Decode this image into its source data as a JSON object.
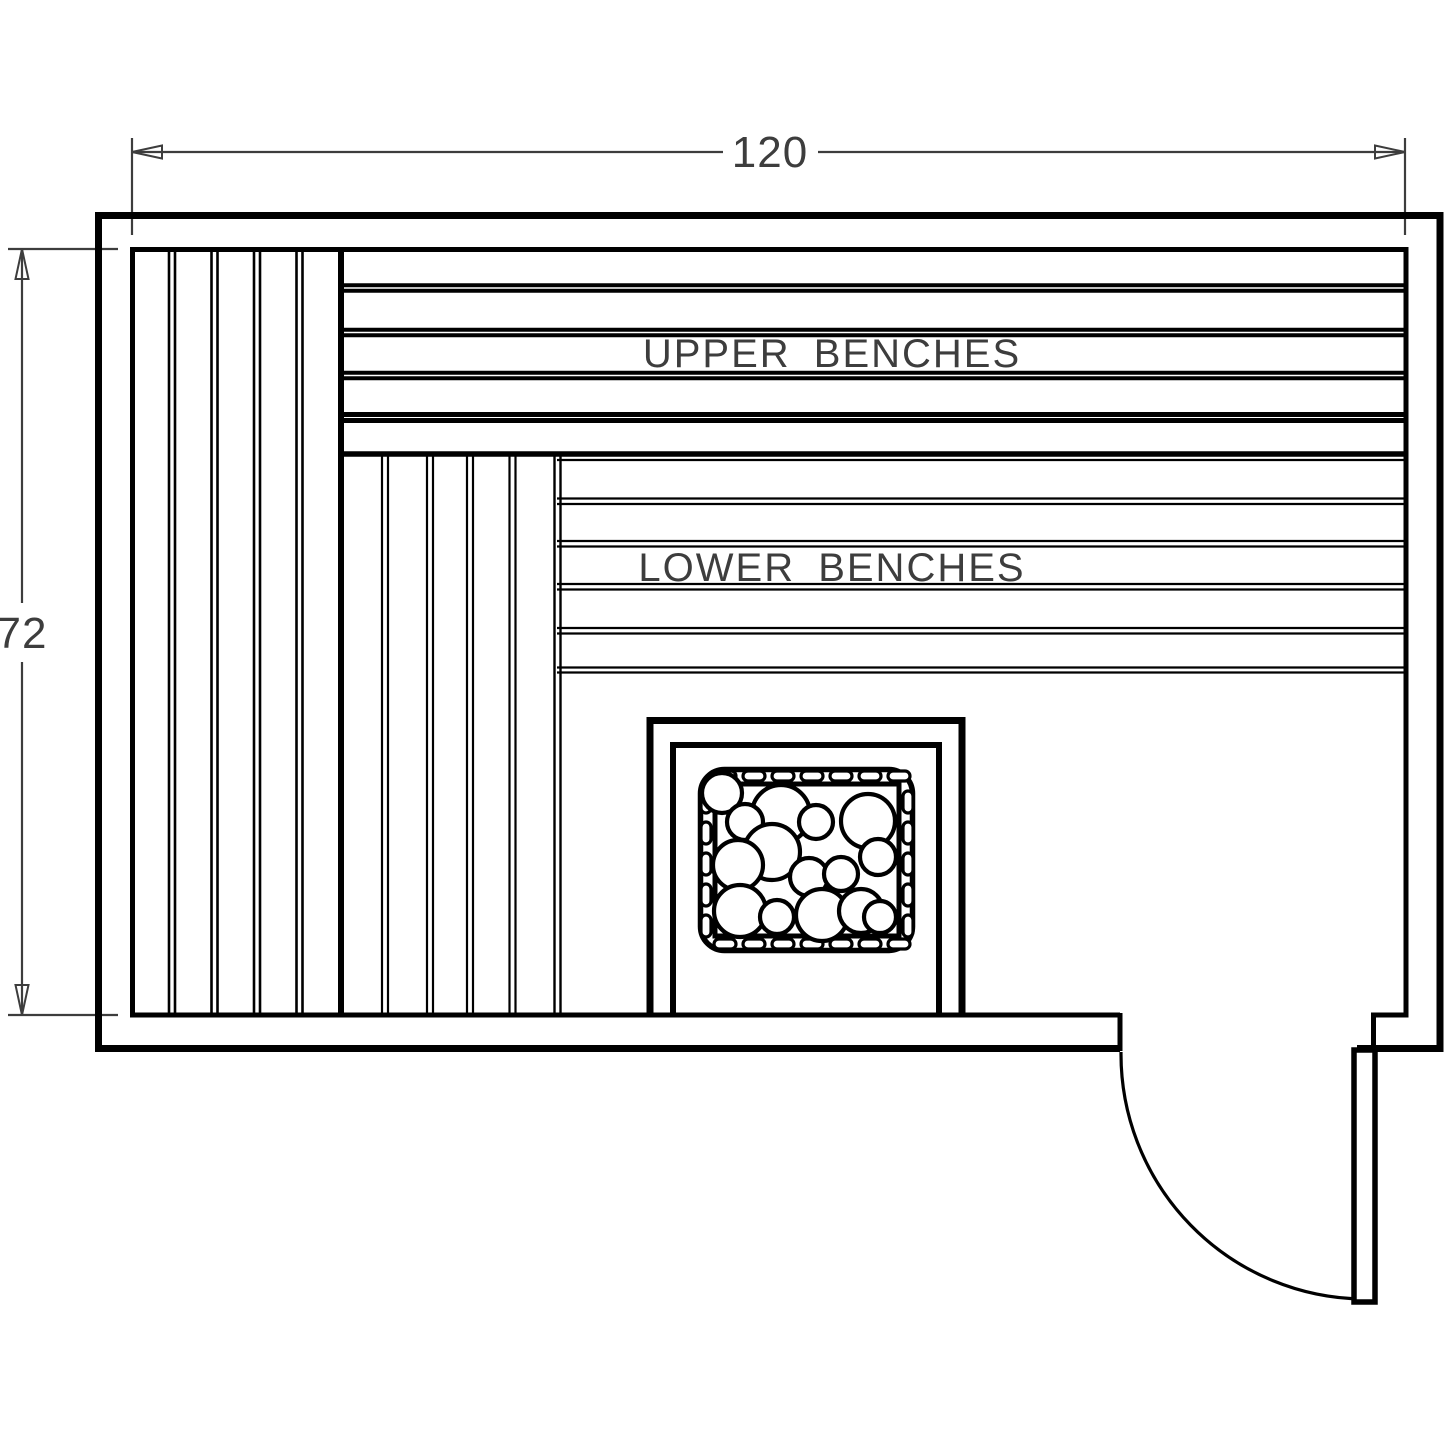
{
  "drawing_labels": {
    "upper_benches": "UPPER BENCHES",
    "lower_benches": "LOWER BENCHES"
  },
  "dimensions": {
    "interior_width": "120",
    "interior_height": "72"
  },
  "colors": {
    "background": "#ffffff",
    "wall_line": "#000000",
    "dimension_line": "#3d3d3d"
  }
}
